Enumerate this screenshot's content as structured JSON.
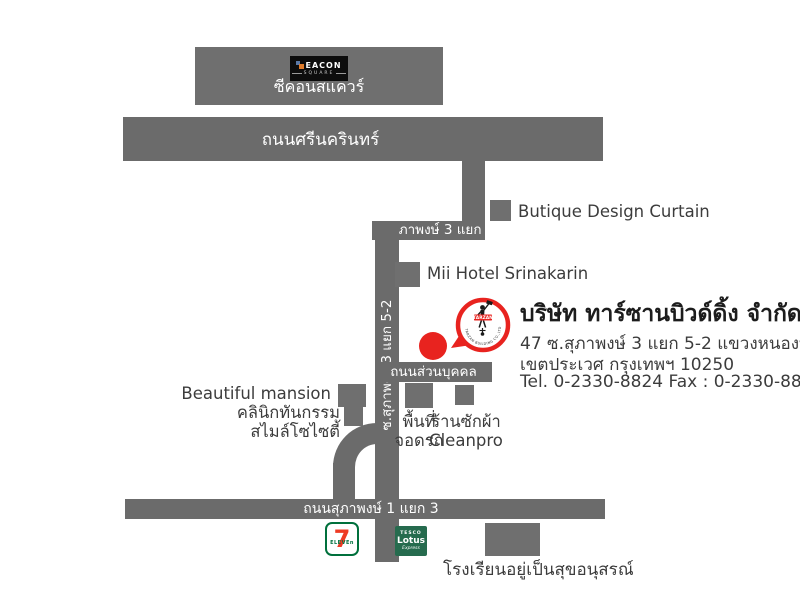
{
  "colors": {
    "road": "#6b6b6b",
    "building": "#6f6f6f",
    "marker_red": "#e8231f",
    "text_dark": "#3c3c3c"
  },
  "seacon": {
    "logo_line1": "EACON",
    "logo_line2": "SQUARE",
    "name_th": "ซีคอนสแควร์"
  },
  "roads": {
    "srinagarindra": "ถนนศรีนครินทร์",
    "soi_suphaphong_3_yaek_5": "ซ.สุภาพงษ์ 3 แยก 5",
    "soi_suphaphong_3_yaek_5_2": "ซ.สุภาพงษ์ 3 แยก 5-2",
    "private_road": "ถนนส่วนบุคคล",
    "suphaphong_1_yaek_3": "ถนนสุภาพงษ์ 1 แยก 3"
  },
  "places": {
    "butique": "Butique Design Curtain",
    "mii_hotel": "Mii Hotel Srinakarin",
    "beautiful_mansion": "Beautiful mansion",
    "clinic_line1": "คลินิกทันกรรม",
    "clinic_line2": "สไมล์โซไซตี้",
    "parking_line1": "พื้นที่",
    "parking_line2": "จอดรถ",
    "laundry_line1": "ร้านซักผ้า",
    "laundry_line2": "Cleanpro",
    "school": "โรงเรียนอยู่เป็นสุขอนุสรณ์"
  },
  "company": {
    "name": "บริษัท ทาร์ซานบิวด์ดิ้ง จำกัด",
    "address_line1": "47 ซ.สุภาพงษ์ 3 แยก 5-2 แขวงหนองบอน",
    "address_line2": "เขตประเวศ กรุงเทพฯ 10250",
    "phone_line": "Tel. 0-2330-8824 Fax : 0-2330-8825",
    "logo_name": "TARZAN",
    "logo_ring_text": "TARZAN BUILDING CO.,LTD."
  },
  "logos": {
    "seven_digit": "7",
    "seven_word": "ELEVEn",
    "tesco_line1": "TESCO",
    "tesco_line2": "Lotus",
    "tesco_line3": "Express"
  }
}
